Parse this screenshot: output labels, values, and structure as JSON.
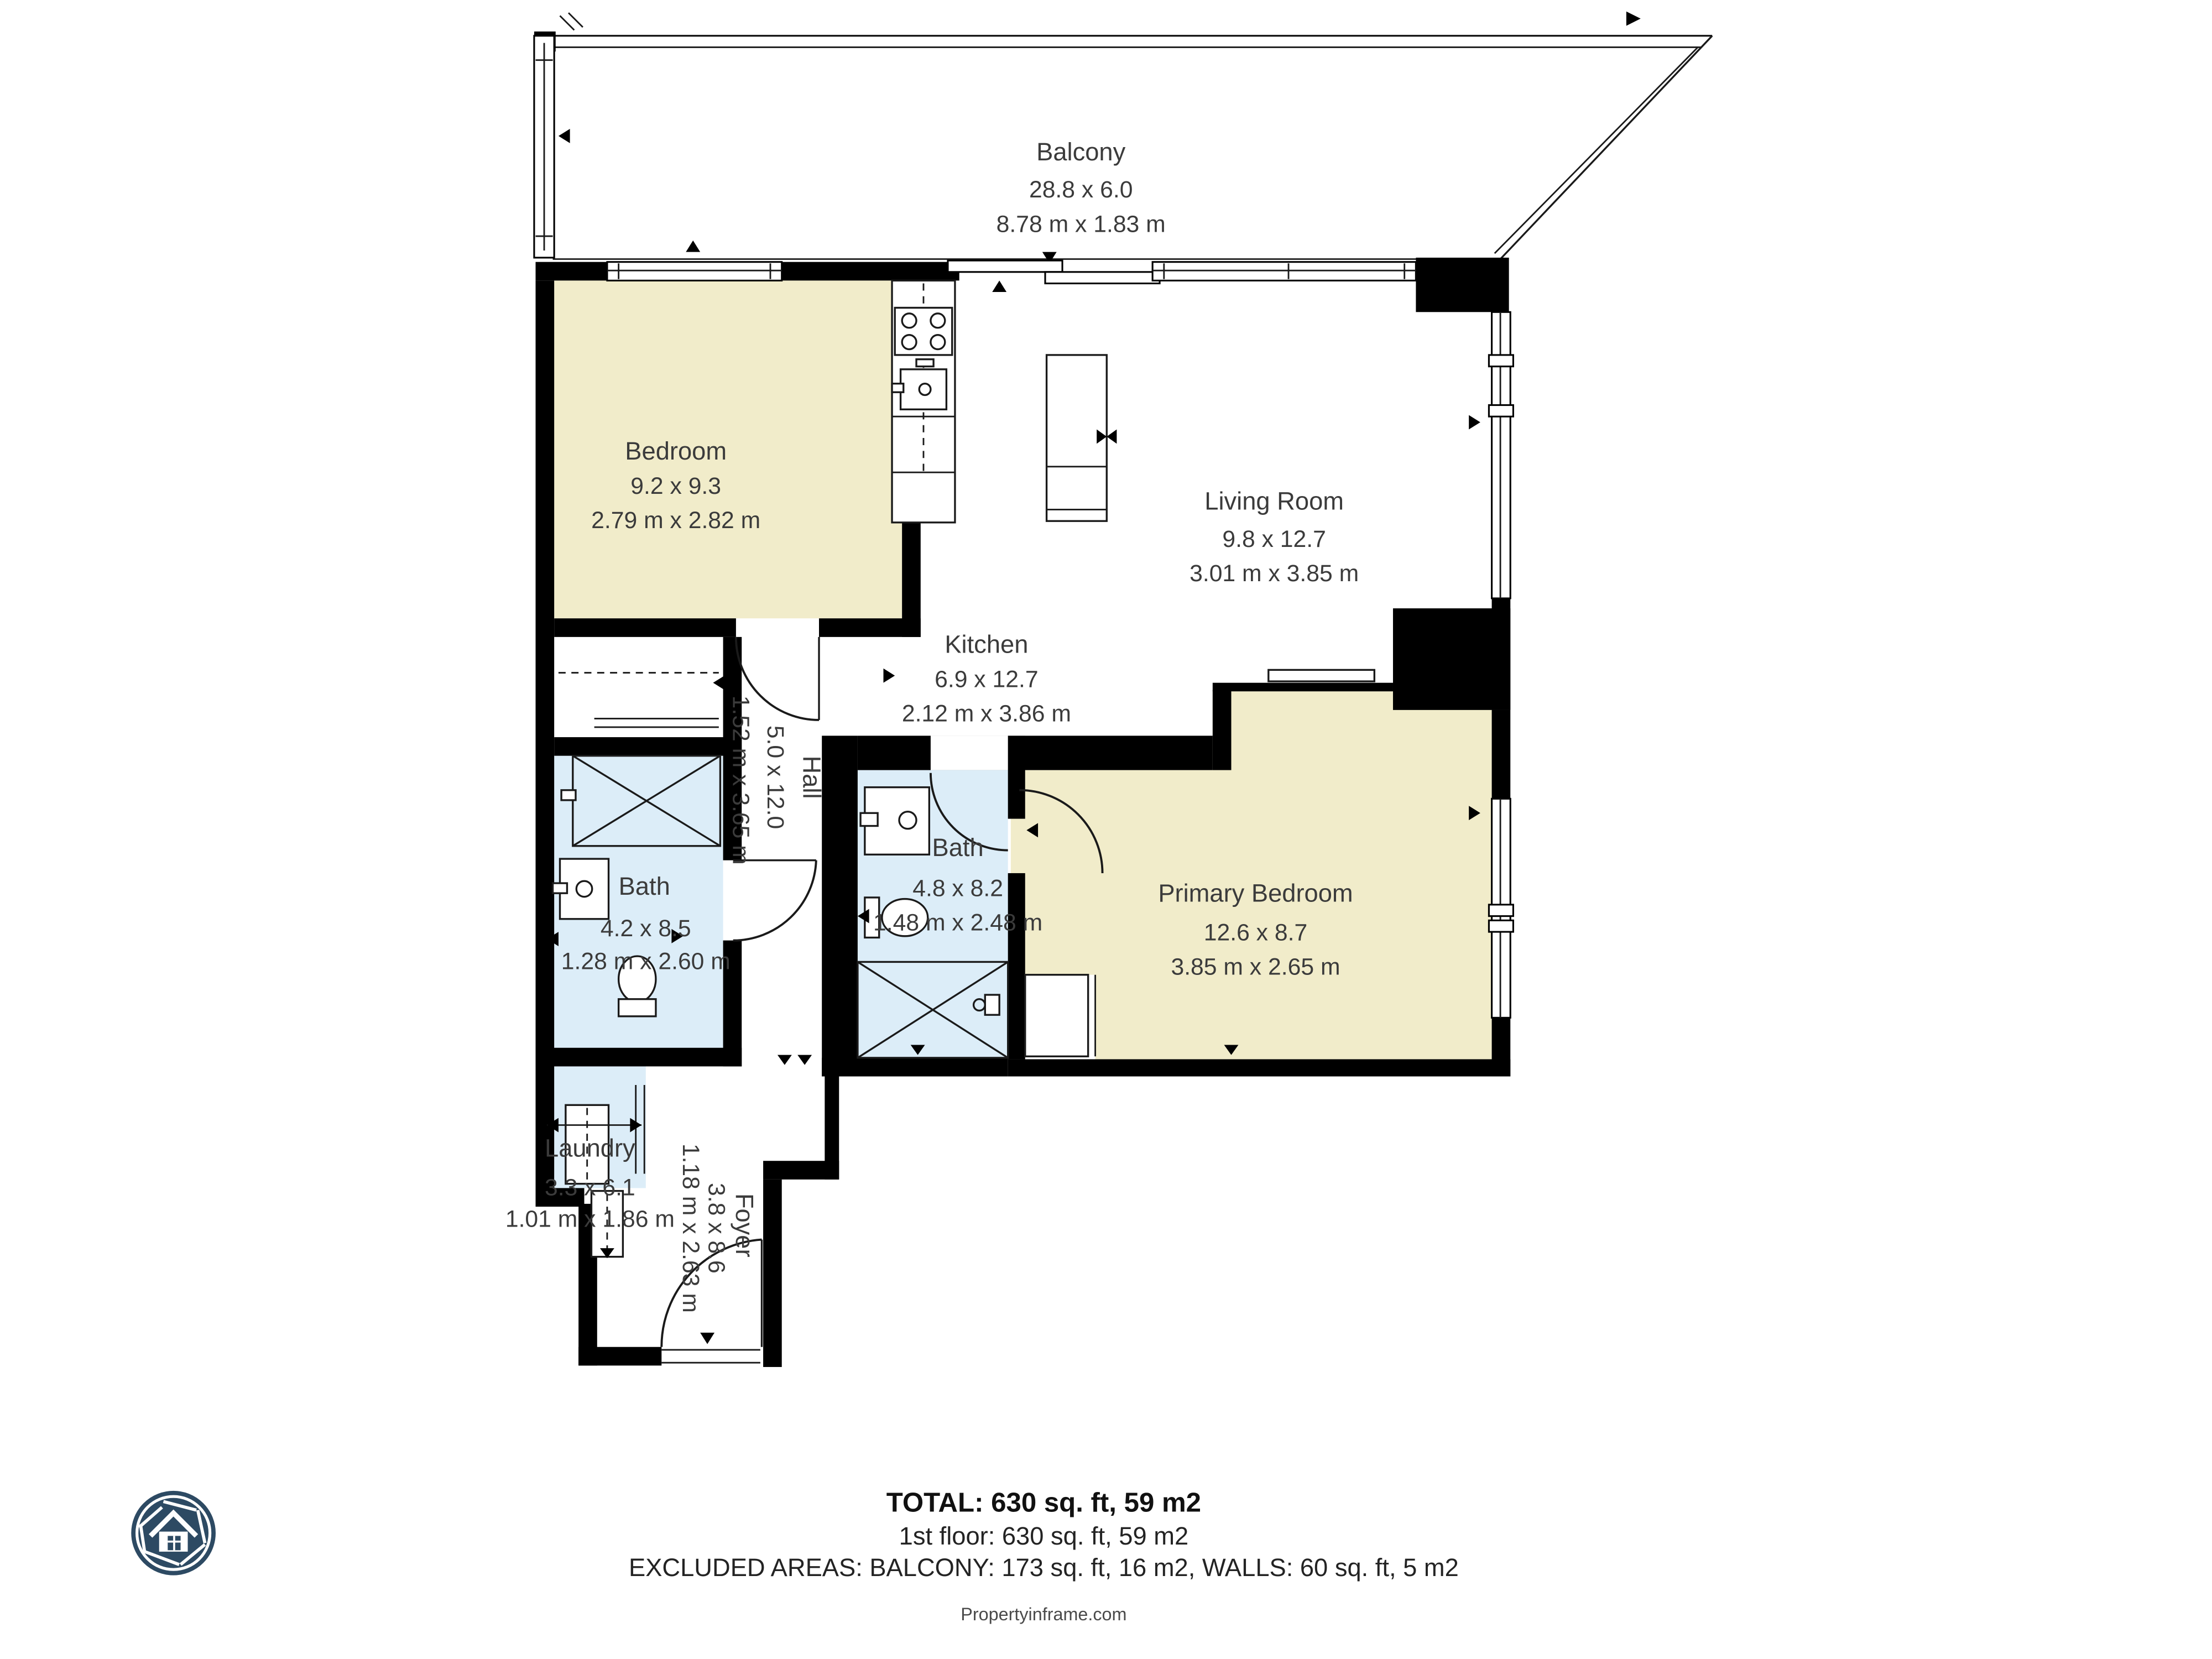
{
  "rooms": {
    "balcony": {
      "name": "Balcony",
      "dims_ft": "28.8 x 6.0",
      "dims_m": "8.78 m x 1.83 m"
    },
    "bedroom": {
      "name": "Bedroom",
      "dims_ft": "9.2 x 9.3",
      "dims_m": "2.79 m x 2.82 m"
    },
    "living_room": {
      "name": "Living Room",
      "dims_ft": "9.8 x 12.7",
      "dims_m": "3.01 m x 3.85 m"
    },
    "kitchen": {
      "name": "Kitchen",
      "dims_ft": "6.9 x 12.7",
      "dims_m": "2.12 m x 3.86 m"
    },
    "hall": {
      "name": "Hall",
      "dims_ft": "5.0 x 12.0",
      "dims_m": "1.52 m x 3.65 m"
    },
    "bath_main": {
      "name": "Bath",
      "dims_ft": "4.8 x 8.2",
      "dims_m": "1.48 m x 2.48 m"
    },
    "primary_bedroom": {
      "name": "Primary Bedroom",
      "dims_ft": "12.6 x 8.7",
      "dims_m": "3.85 m x 2.65 m"
    },
    "bath_left": {
      "name": "Bath",
      "dims_ft": "4.2 x 8.5",
      "dims_m": "1.28 m x 2.60 m"
    },
    "laundry": {
      "name": "Laundry",
      "dims_ft": "3.3 x 6.1",
      "dims_m": "1.01 m x 1.86 m"
    },
    "foyer": {
      "name": "Foyer",
      "dims_ft": "3.8 x 8.6",
      "dims_m": "1.18 m x 2.63 m"
    }
  },
  "summary": {
    "total": "TOTAL: 630 sq. ft, 59 m2",
    "floor": "1st floor: 630 sq. ft, 59 m2",
    "excluded": "EXCLUDED AREAS: BALCONY: 173 sq. ft, 16 m2, WALLS: 60 sq. ft, 5 m2",
    "watermark": "Propertyinframe.com"
  },
  "colors": {
    "room_beige": "#f1ecca",
    "room_blue": "#dcedf8",
    "wall_black": "#000000",
    "logo_navy": "#2d4a63",
    "text_gray": "#3b3b3b"
  }
}
